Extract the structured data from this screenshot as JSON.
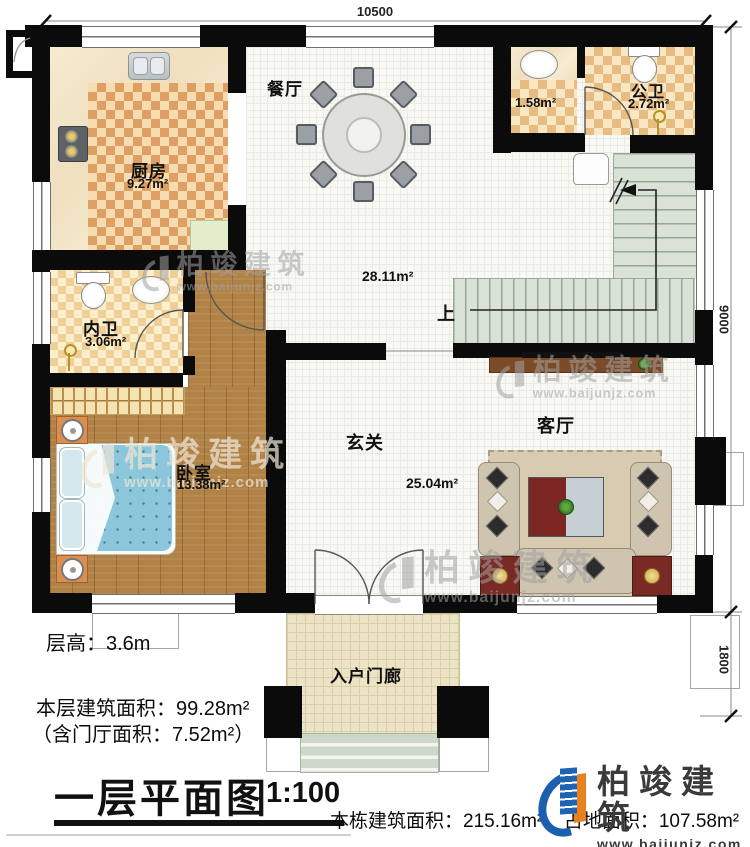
{
  "doc": {
    "type": "first-floor plan drawing"
  },
  "dimensions": {
    "top": "10500",
    "right_upper": "9000",
    "right_lower": "1800"
  },
  "rooms": {
    "dining": {
      "name": "餐厅"
    },
    "kitchen": {
      "name": "厨房",
      "area": "9.27m²"
    },
    "public_bath": {
      "name": "公卫",
      "area": "2.72m²"
    },
    "washbasin_area": {
      "area": "1.58m²"
    },
    "hallway": {
      "area": "28.11m²"
    },
    "stairs": {
      "up_label": "上"
    },
    "inner_bath": {
      "name": "内卫",
      "area": "3.06m²"
    },
    "foyer": {
      "name": "玄关",
      "area": "25.04m²"
    },
    "living": {
      "name": "客厅"
    },
    "bedroom": {
      "name": "卧室",
      "area": "13.38m²"
    },
    "entry_porch": {
      "name": "入户门廊"
    }
  },
  "notes": {
    "floor_height": "层高：3.6m",
    "floor_area": "本层建筑面积：99.28m²",
    "porch_area_note": "（含门厅面积：7.52m²）"
  },
  "titleblock": {
    "title": "一层平面图",
    "scale": "1:100",
    "total_area": "本栋建筑面积：215.16m²",
    "site_area": "占地面积：107.58m²"
  },
  "branding": {
    "name": "柏竣建筑",
    "url": "www.baijunjz.com"
  },
  "colors": {
    "wall": "#0b0b0b",
    "wood": "#b08246",
    "stair": "#dae1d6",
    "brand_blue": "#1b5fae",
    "brand_orange": "#e8821e"
  }
}
